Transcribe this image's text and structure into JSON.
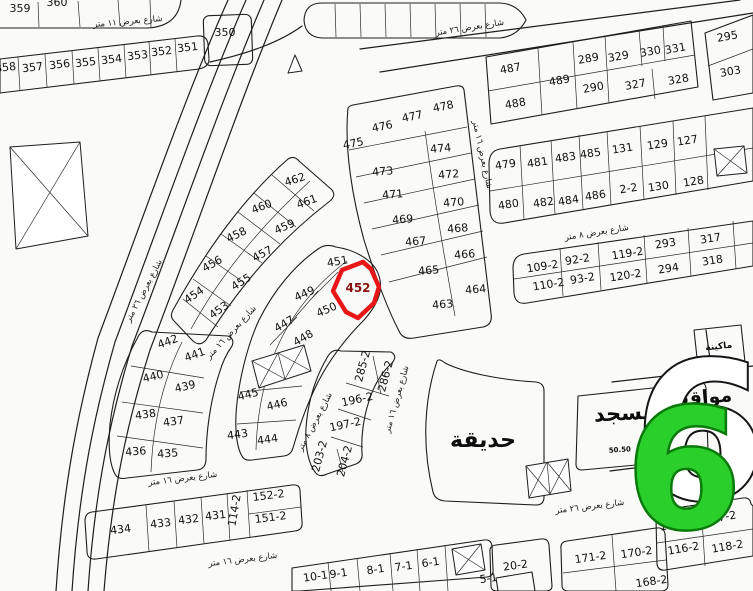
{
  "map": {
    "background": "#fafaf8",
    "line_color": "#1d1d1d",
    "highlight": {
      "plot": "452",
      "color": "#e81717"
    },
    "badge": {
      "text": "6",
      "shadow_text": "6",
      "fill": "#2bcf2b",
      "edge": "#0a7a0a"
    },
    "areas": [
      {
        "label": "حديقة",
        "x": 483,
        "y": 447,
        "fs": 22,
        "r": 0
      },
      {
        "label": "مسجد",
        "x": 625,
        "y": 420,
        "fs": 21,
        "r": -3
      },
      {
        "label": "مواقف",
        "x": 700,
        "y": 404,
        "fs": 19,
        "r": -5
      },
      {
        "label": "ماكينة",
        "x": 719,
        "y": 349,
        "fs": 9,
        "r": -6
      },
      {
        "label": "50.50",
        "x": 620,
        "y": 452,
        "fs": 7,
        "r": -4
      }
    ],
    "streets": [
      {
        "label": "شارع بعرض ١١ متر",
        "x": 128,
        "y": 24,
        "r": -5
      },
      {
        "label": "شارع بعرض ٢٦ متر",
        "x": 470,
        "y": 30,
        "r": -9
      },
      {
        "label": "شارع بعرض ٨ متر",
        "x": 597,
        "y": 235,
        "r": -9
      },
      {
        "label": "شارع بعرض ١٦ متر",
        "x": 480,
        "y": 155,
        "r": 78
      },
      {
        "label": "شارع بعرض ٢٦ متر",
        "x": 146,
        "y": 292,
        "r": -62
      },
      {
        "label": "شارع بعرض ١٦ متر",
        "x": 233,
        "y": 334,
        "r": -47
      },
      {
        "label": "شارع بعرض ١٦ متر",
        "x": 183,
        "y": 481,
        "r": -7
      },
      {
        "label": "شارع بعرض ١٦ متر",
        "x": 243,
        "y": 562,
        "r": -7
      },
      {
        "label": "شارع بعرض ٢٦ متر",
        "x": 590,
        "y": 509,
        "r": -7
      },
      {
        "label": "شارع بعرض ١٦ متر",
        "x": 399,
        "y": 400,
        "r": -74
      },
      {
        "label": "شارع بعرض ٨ متر",
        "x": 317,
        "y": 423,
        "r": -62
      }
    ],
    "plots": [
      {
        "n": "359",
        "x": 20,
        "y": 12,
        "r": 0
      },
      {
        "n": "360",
        "x": 57,
        "y": 6,
        "r": 0
      },
      {
        "n": "350",
        "x": 225,
        "y": 36,
        "r": 0
      },
      {
        "n": "358",
        "x": 6,
        "y": 71,
        "r": -7
      },
      {
        "n": "357",
        "x": 33,
        "y": 71,
        "r": -7
      },
      {
        "n": "356",
        "x": 60,
        "y": 68,
        "r": -7
      },
      {
        "n": "355",
        "x": 86,
        "y": 66,
        "r": -7
      },
      {
        "n": "354",
        "x": 112,
        "y": 63,
        "r": -7
      },
      {
        "n": "353",
        "x": 138,
        "y": 59,
        "r": -7
      },
      {
        "n": "352",
        "x": 162,
        "y": 55,
        "r": -7
      },
      {
        "n": "351",
        "x": 188,
        "y": 51,
        "r": -7
      },
      {
        "n": "487",
        "x": 511,
        "y": 72,
        "r": -10
      },
      {
        "n": "488",
        "x": 516,
        "y": 107,
        "r": -10
      },
      {
        "n": "489",
        "x": 560,
        "y": 84,
        "r": -10
      },
      {
        "n": "289",
        "x": 589,
        "y": 62,
        "r": -10
      },
      {
        "n": "290",
        "x": 594,
        "y": 91,
        "r": -10
      },
      {
        "n": "329",
        "x": 619,
        "y": 60,
        "r": -10
      },
      {
        "n": "327",
        "x": 636,
        "y": 88,
        "r": -10
      },
      {
        "n": "330",
        "x": 651,
        "y": 55,
        "r": -10
      },
      {
        "n": "328",
        "x": 679,
        "y": 83,
        "r": -10
      },
      {
        "n": "331",
        "x": 676,
        "y": 52,
        "r": -10
      },
      {
        "n": "295",
        "x": 728,
        "y": 40,
        "r": -10
      },
      {
        "n": "303",
        "x": 731,
        "y": 75,
        "r": -10
      },
      {
        "n": "479",
        "x": 506,
        "y": 168,
        "r": -9
      },
      {
        "n": "481",
        "x": 538,
        "y": 166,
        "r": -9
      },
      {
        "n": "483",
        "x": 566,
        "y": 161,
        "r": -9
      },
      {
        "n": "485",
        "x": 591,
        "y": 157,
        "r": -9
      },
      {
        "n": "131",
        "x": 623,
        "y": 152,
        "r": -9
      },
      {
        "n": "129",
        "x": 658,
        "y": 148,
        "r": -9
      },
      {
        "n": "127",
        "x": 688,
        "y": 144,
        "r": -9
      },
      {
        "n": "480",
        "x": 509,
        "y": 208,
        "r": -9
      },
      {
        "n": "482",
        "x": 544,
        "y": 206,
        "r": -9
      },
      {
        "n": "484",
        "x": 569,
        "y": 204,
        "r": -9
      },
      {
        "n": "486",
        "x": 596,
        "y": 199,
        "r": -9
      },
      {
        "n": "2-2",
        "x": 629,
        "y": 192,
        "r": -9
      },
      {
        "n": "130",
        "x": 659,
        "y": 190,
        "r": -9
      },
      {
        "n": "128",
        "x": 694,
        "y": 185,
        "r": -9
      },
      {
        "n": "109-2",
        "x": 543,
        "y": 270,
        "r": -9,
        "fs": 10
      },
      {
        "n": "92-2",
        "x": 578,
        "y": 263,
        "r": -9,
        "fs": 10
      },
      {
        "n": "119-2",
        "x": 628,
        "y": 257,
        "r": -9,
        "fs": 10
      },
      {
        "n": "293",
        "x": 666,
        "y": 247,
        "r": -9
      },
      {
        "n": "317",
        "x": 711,
        "y": 242,
        "r": -9
      },
      {
        "n": "110-2",
        "x": 549,
        "y": 288,
        "r": -9,
        "fs": 10
      },
      {
        "n": "93-2",
        "x": 583,
        "y": 282,
        "r": -9,
        "fs": 10
      },
      {
        "n": "120-2",
        "x": 626,
        "y": 279,
        "r": -9,
        "fs": 10
      },
      {
        "n": "294",
        "x": 669,
        "y": 272,
        "r": -9
      },
      {
        "n": "318",
        "x": 713,
        "y": 264,
        "r": -9
      },
      {
        "n": "475",
        "x": 354,
        "y": 147,
        "r": -12
      },
      {
        "n": "476",
        "x": 383,
        "y": 130,
        "r": -12
      },
      {
        "n": "477",
        "x": 413,
        "y": 120,
        "r": -12
      },
      {
        "n": "478",
        "x": 444,
        "y": 110,
        "r": -12
      },
      {
        "n": "473",
        "x": 383,
        "y": 175,
        "r": -5
      },
      {
        "n": "474",
        "x": 441,
        "y": 152,
        "r": -5
      },
      {
        "n": "471",
        "x": 393,
        "y": 198,
        "r": -5
      },
      {
        "n": "472",
        "x": 449,
        "y": 178,
        "r": -5
      },
      {
        "n": "469",
        "x": 403,
        "y": 223,
        "r": -5
      },
      {
        "n": "470",
        "x": 454,
        "y": 206,
        "r": -5
      },
      {
        "n": "467",
        "x": 416,
        "y": 245,
        "r": -5
      },
      {
        "n": "468",
        "x": 458,
        "y": 232,
        "r": -5
      },
      {
        "n": "465",
        "x": 429,
        "y": 274,
        "r": -5
      },
      {
        "n": "466",
        "x": 465,
        "y": 258,
        "r": -5
      },
      {
        "n": "463",
        "x": 443,
        "y": 308,
        "r": -5
      },
      {
        "n": "464",
        "x": 476,
        "y": 293,
        "r": -5
      },
      {
        "n": "462",
        "x": 296,
        "y": 183,
        "r": -18
      },
      {
        "n": "461",
        "x": 308,
        "y": 205,
        "r": -20
      },
      {
        "n": "460",
        "x": 263,
        "y": 210,
        "r": -22
      },
      {
        "n": "459",
        "x": 286,
        "y": 230,
        "r": -24
      },
      {
        "n": "458",
        "x": 238,
        "y": 238,
        "r": -26
      },
      {
        "n": "457",
        "x": 264,
        "y": 257,
        "r": -28
      },
      {
        "n": "456",
        "x": 214,
        "y": 267,
        "r": -30
      },
      {
        "n": "455",
        "x": 243,
        "y": 285,
        "r": -32
      },
      {
        "n": "454",
        "x": 196,
        "y": 298,
        "r": -34
      },
      {
        "n": "453",
        "x": 221,
        "y": 313,
        "r": -36
      },
      {
        "n": "451",
        "x": 338,
        "y": 265,
        "r": -10
      },
      {
        "n": "449",
        "x": 306,
        "y": 297,
        "r": -24
      },
      {
        "n": "450",
        "x": 328,
        "y": 313,
        "r": -24
      },
      {
        "n": "447",
        "x": 286,
        "y": 327,
        "r": -30
      },
      {
        "n": "448",
        "x": 305,
        "y": 341,
        "r": -30
      },
      {
        "n": "445",
        "x": 249,
        "y": 398,
        "r": -14
      },
      {
        "n": "446",
        "x": 278,
        "y": 408,
        "r": -14
      },
      {
        "n": "443",
        "x": 238,
        "y": 438,
        "r": -8
      },
      {
        "n": "444",
        "x": 268,
        "y": 443,
        "r": -8
      },
      {
        "n": "442",
        "x": 169,
        "y": 345,
        "r": -20
      },
      {
        "n": "441",
        "x": 196,
        "y": 358,
        "r": -20
      },
      {
        "n": "440",
        "x": 154,
        "y": 380,
        "r": -14
      },
      {
        "n": "439",
        "x": 186,
        "y": 390,
        "r": -14
      },
      {
        "n": "438",
        "x": 146,
        "y": 418,
        "r": -8
      },
      {
        "n": "437",
        "x": 174,
        "y": 425,
        "r": -8
      },
      {
        "n": "436",
        "x": 136,
        "y": 455,
        "r": -4
      },
      {
        "n": "435",
        "x": 168,
        "y": 457,
        "r": -4
      },
      {
        "n": "434",
        "x": 121,
        "y": 533,
        "r": -7
      },
      {
        "n": "433",
        "x": 161,
        "y": 527,
        "r": -7
      },
      {
        "n": "432",
        "x": 189,
        "y": 523,
        "r": -7
      },
      {
        "n": "431",
        "x": 216,
        "y": 519,
        "r": -7
      },
      {
        "n": "114-2",
        "x": 238,
        "y": 511,
        "r": -80,
        "fs": 9
      },
      {
        "n": "152-2",
        "x": 269,
        "y": 499,
        "r": -7,
        "fs": 10
      },
      {
        "n": "151-2",
        "x": 271,
        "y": 521,
        "r": -7,
        "fs": 10
      },
      {
        "n": "285-2",
        "x": 366,
        "y": 367,
        "r": -75,
        "fs": 10
      },
      {
        "n": "286-2",
        "x": 389,
        "y": 377,
        "r": -75,
        "fs": 10
      },
      {
        "n": "196-2",
        "x": 358,
        "y": 403,
        "r": -12,
        "fs": 10
      },
      {
        "n": "197-2",
        "x": 346,
        "y": 428,
        "r": -12,
        "fs": 10
      },
      {
        "n": "203-2",
        "x": 323,
        "y": 457,
        "r": -75,
        "fs": 10
      },
      {
        "n": "204-2",
        "x": 348,
        "y": 462,
        "r": -75,
        "fs": 10
      },
      {
        "n": "20-2",
        "x": 516,
        "y": 569,
        "r": -8
      },
      {
        "n": "171-2",
        "x": 591,
        "y": 561,
        "r": -8,
        "fs": 10
      },
      {
        "n": "170-2",
        "x": 637,
        "y": 556,
        "r": -8,
        "fs": 10
      },
      {
        "n": "168-2",
        "x": 652,
        "y": 585,
        "r": -8,
        "fs": 10
      },
      {
        "n": "115-2",
        "x": 676,
        "y": 528,
        "r": -10,
        "fs": 10
      },
      {
        "n": "117-2",
        "x": 721,
        "y": 521,
        "r": -10,
        "fs": 10
      },
      {
        "n": "116-2",
        "x": 684,
        "y": 552,
        "r": -10,
        "fs": 10
      },
      {
        "n": "118-2",
        "x": 728,
        "y": 550,
        "r": -10,
        "fs": 10
      },
      {
        "n": "10-1",
        "x": 316,
        "y": 580,
        "r": -8,
        "fs": 10
      },
      {
        "n": "9-1",
        "x": 339,
        "y": 577,
        "r": -8,
        "fs": 10
      },
      {
        "n": "8-1",
        "x": 376,
        "y": 573,
        "r": -8,
        "fs": 10
      },
      {
        "n": "7-1",
        "x": 404,
        "y": 570,
        "r": -8,
        "fs": 10
      },
      {
        "n": "6-1",
        "x": 431,
        "y": 566,
        "r": -8,
        "fs": 10
      },
      {
        "n": "5-1",
        "x": 489,
        "y": 582,
        "r": -8,
        "fs": 10
      }
    ]
  }
}
